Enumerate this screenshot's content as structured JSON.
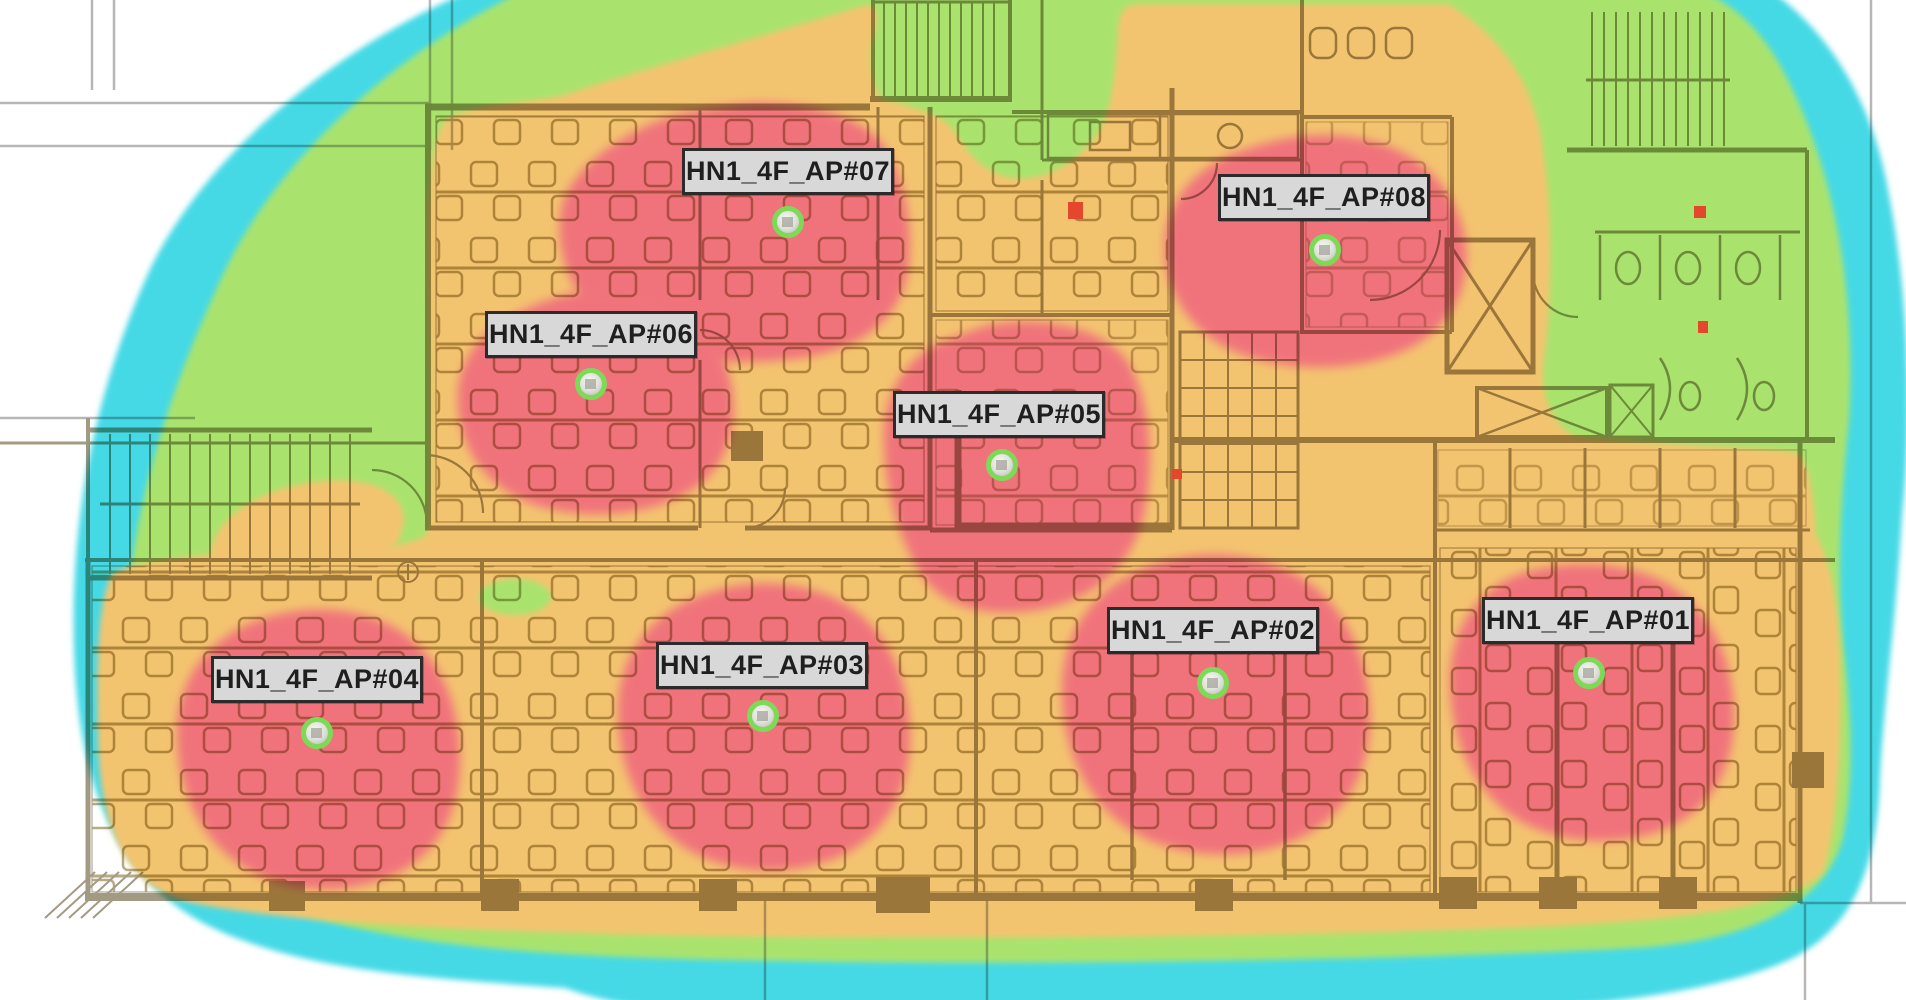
{
  "aps": [
    {
      "id": "ap01",
      "label": "HN1_4F_AP#01"
    },
    {
      "id": "ap02",
      "label": "HN1_4F_AP#02"
    },
    {
      "id": "ap03",
      "label": "HN1_4F_AP#03"
    },
    {
      "id": "ap04",
      "label": "HN1_4F_AP#04"
    },
    {
      "id": "ap05",
      "label": "HN1_4F_AP#05"
    },
    {
      "id": "ap06",
      "label": "HN1_4F_AP#06"
    },
    {
      "id": "ap07",
      "label": "HN1_4F_AP#07"
    },
    {
      "id": "ap08",
      "label": "HN1_4F_AP#08"
    }
  ],
  "colors": {
    "background": "#ffffff",
    "signal_strongest": "#f0737c",
    "signal_strong": "#f3c46f",
    "signal_medium": "#a9e36e",
    "signal_weak": "#45d9e6",
    "floorplan_ink": "#6a5c38",
    "grid_line": "#8a8a8a",
    "alarm_dot": "#e5472c",
    "label_bg": "#d8d8d8",
    "label_border": "#2b2b2b",
    "ap_icon_ring": "#7ed957"
  }
}
